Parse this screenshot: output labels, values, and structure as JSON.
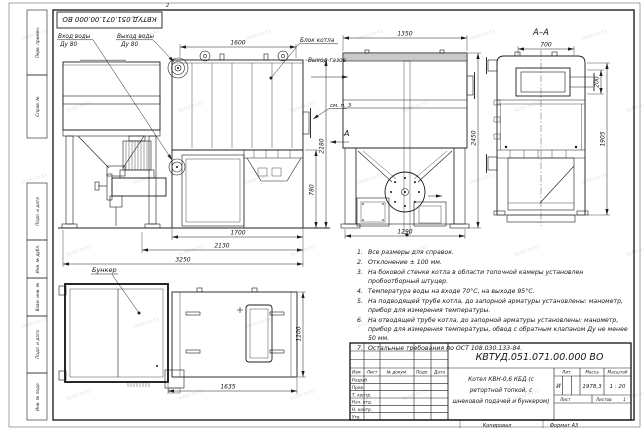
{
  "watermark": "kotel-kv.kz",
  "top_mark": "2",
  "stamp": {
    "designation": "КВТУД.051.071.00.000 ВО"
  },
  "margin_fields": {
    "f1": "Перв. примен.",
    "f2": "Справ. №",
    "f3": "Подп. и дата",
    "f4": "Инв. № дубл.",
    "f5": "Взам. инв. №",
    "f6": "Подп. и дата",
    "f7": "Инв. № подл."
  },
  "labels": {
    "water_in_1": "Вход воды",
    "water_in_2": "Ду 80",
    "water_out_1": "Выход воды",
    "water_out_2": "Ду 80",
    "boiler_block": "Блок котла",
    "gas_out": "Выход газов",
    "see_note3": "см. п. 3",
    "section": "А–А",
    "view_arrow": "А",
    "bunker": "Бункер"
  },
  "dims": {
    "boiler_length": "1600",
    "front_width_top": "1350",
    "section_opening": "700",
    "pipe_offset": "200",
    "section_height": "1905",
    "front_height": "2450",
    "side_height": "2180",
    "firebox_height": "780",
    "firebox_length": "1700",
    "feeder_length": "2130",
    "overall_length": "3250",
    "front_width_bottom": "1290",
    "plan_length": "1635",
    "plan_width": "1100"
  },
  "notes": [
    {
      "n": "1.",
      "text": "Все размеры для справок."
    },
    {
      "n": "2.",
      "text": "Отклонение ± 100 мм."
    },
    {
      "n": "3.",
      "text": "На боковой стенке котла в области топочной камеры установлен пробоотборный штуцер."
    },
    {
      "n": "4.",
      "text": "Температура воды на входе 70°С, на выходе 95°С."
    },
    {
      "n": "5.",
      "text": "На подводящей трубе котла, до запорной арматуры установлены: манометр, прибор для измерения температуры."
    },
    {
      "n": "6.",
      "text": "На отводящей трубе котла, до запорной арматуры установлены: манометр, прибор для измерения температуры, обвод с обратным клапаном Ду не менее 50 мм."
    },
    {
      "n": "7.",
      "text": "Остальные требования по ОСТ 108.030.133-84."
    }
  ],
  "title_block": {
    "designation": "КВТУД.051.071.00.000 ВО",
    "name_line1": "Котел КВН-0,6 КБД (с",
    "name_line2": "ретортной топкой, с",
    "name_line3": "шнековой подачей и бункером)",
    "header": {
      "izm": "Изм.",
      "list": "Лист",
      "doc": "№ докум.",
      "podp": "Подп.",
      "data": "Дата"
    },
    "rows": [
      "Разраб.",
      "Пров.",
      "Т. контр.",
      "Нач. отд.",
      "Н. контр.",
      "Утв."
    ],
    "lit_label": "Лит.",
    "lit_value": "И",
    "mass_label": "Масса",
    "mass_value": "1978,3",
    "scale_label": "Масштаб",
    "scale_value": "1 : 20",
    "sheet_label": "Лист",
    "sheets_label": "Листов",
    "sheets_value": "1",
    "copied_label": "Копировал",
    "format_label": "Формат А3"
  }
}
